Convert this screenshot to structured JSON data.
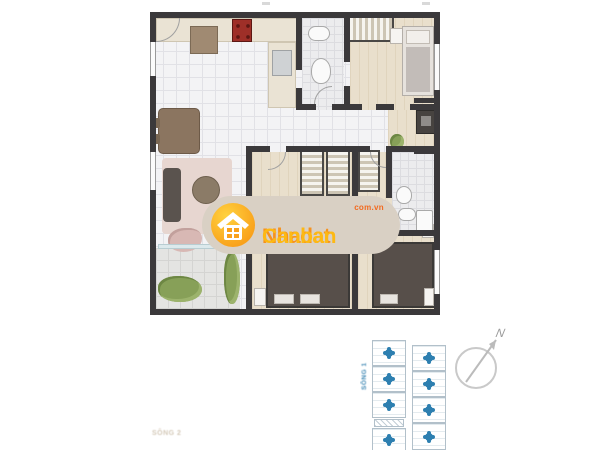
{
  "watermark": {
    "brand_part1": "Nhadat",
    "brand_part2": "Canban",
    "domain_suffix": "com.vn"
  },
  "key_plan": {
    "block_label": "SÔNG 1",
    "left_column_units": 4,
    "right_column_units": 4
  },
  "compass": {
    "north_label": "N"
  },
  "plan_footer_label": "SÔNG 2",
  "colors": {
    "watermark_pill": "#d9d0c4",
    "brand_orange": "#f6921e",
    "brand_yellow": "#fdb913",
    "domain_orange": "#f26a1f",
    "keyplan_marker": "#2d7fb0",
    "wall": "#3b393b",
    "wood_floor": "#e9dfcc",
    "stove_red": "#9e2f28"
  }
}
